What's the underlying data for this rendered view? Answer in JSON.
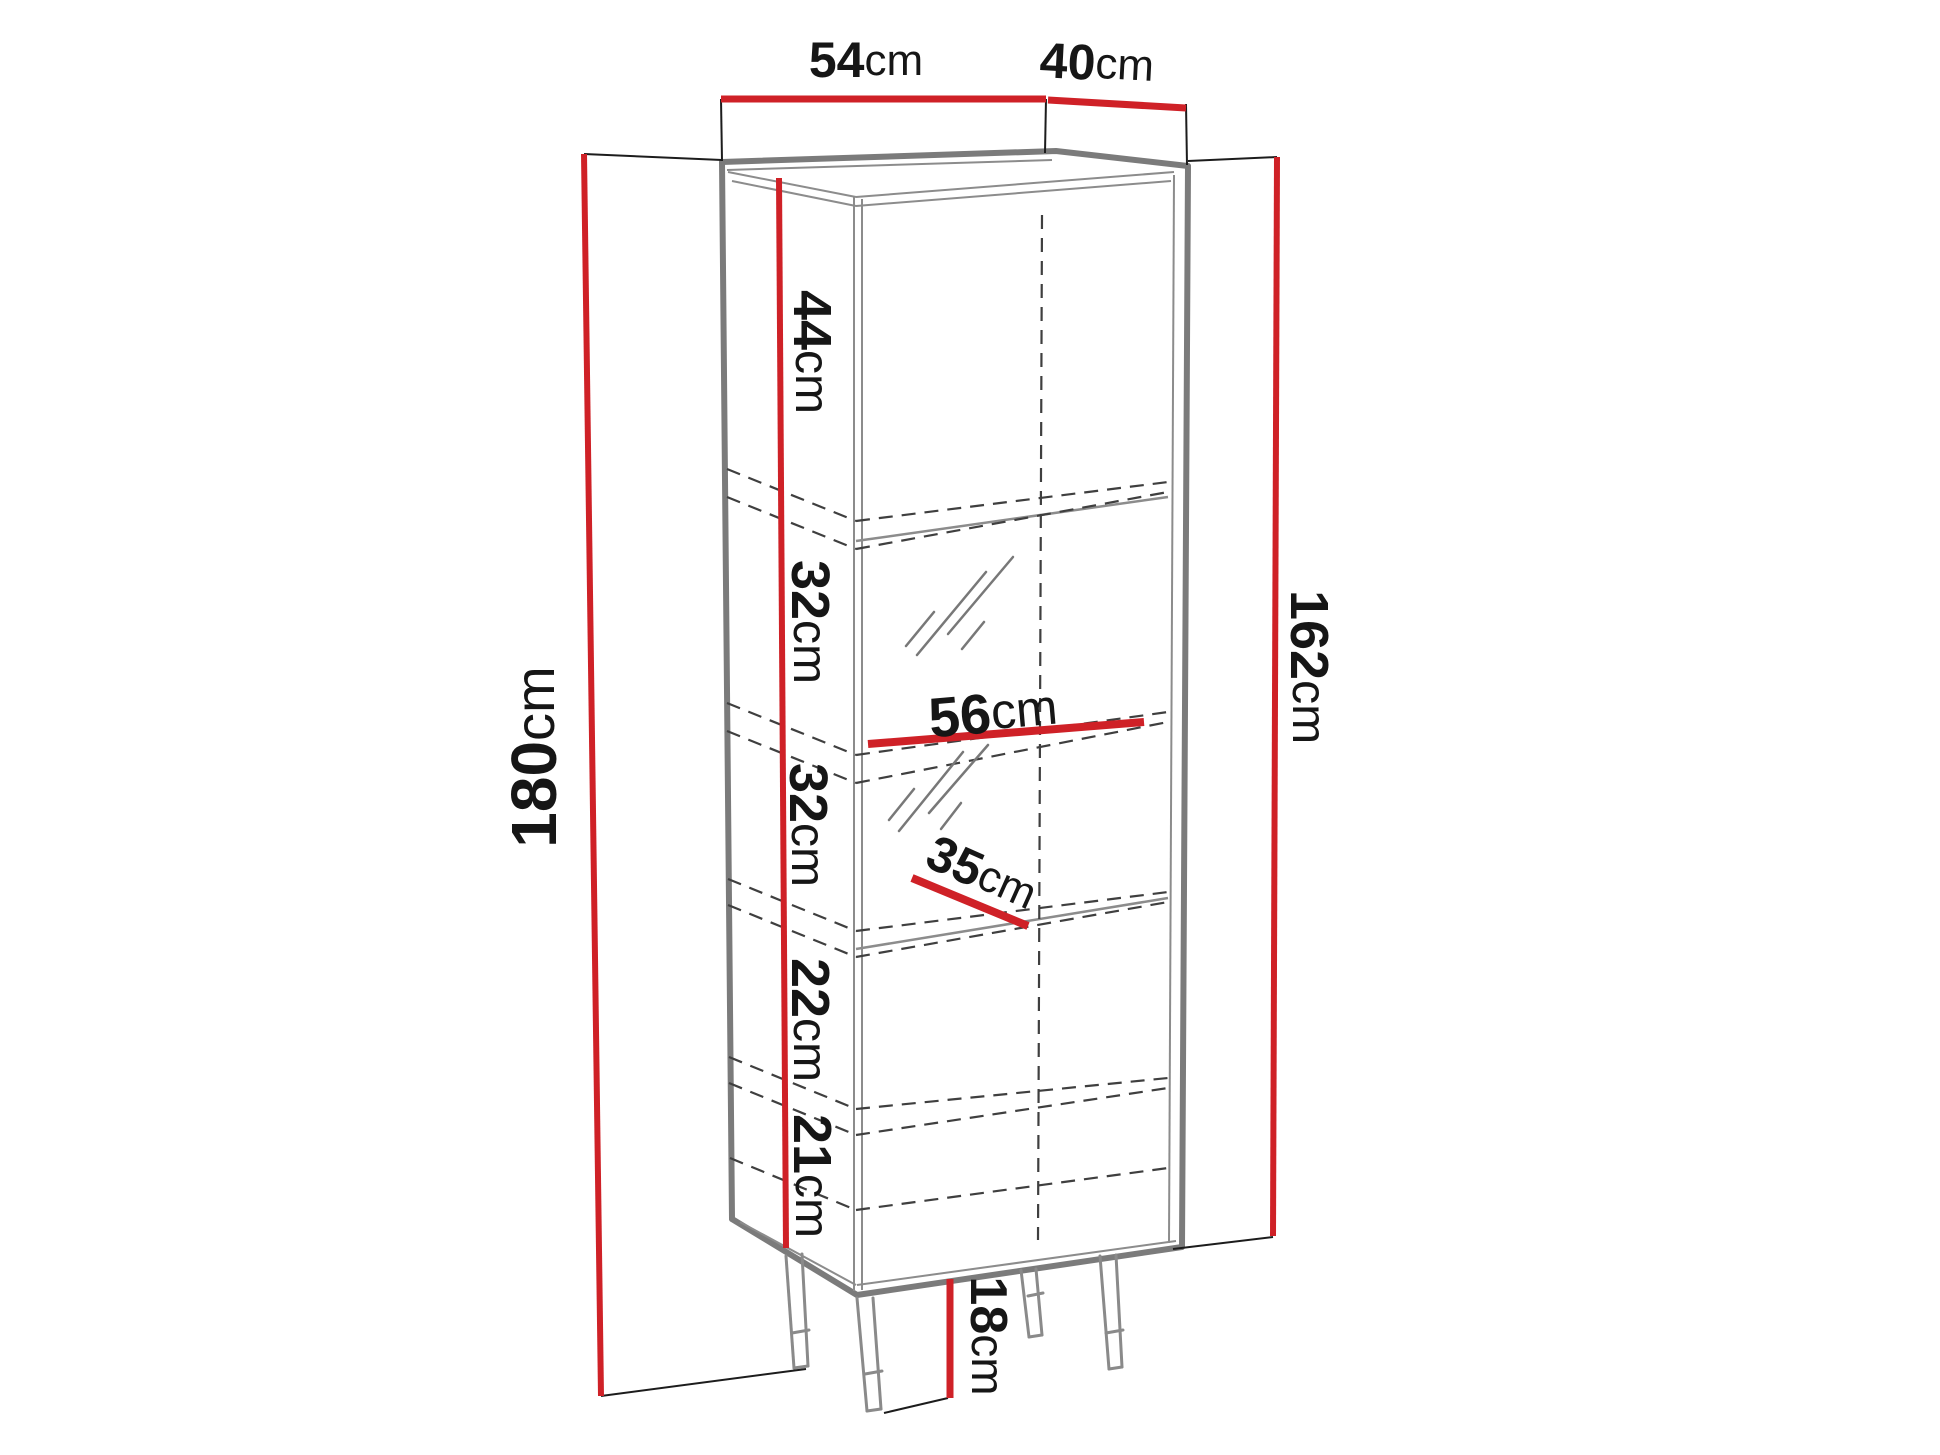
{
  "diagram": {
    "top_width": {
      "num": "54",
      "unit": "cm"
    },
    "top_depth": {
      "num": "40",
      "unit": "cm"
    },
    "total_height": {
      "num": "180",
      "unit": "cm"
    },
    "body_height": {
      "num": "162",
      "unit": "cm"
    },
    "sections": [
      {
        "num": "44",
        "unit": "cm"
      },
      {
        "num": "32",
        "unit": "cm"
      },
      {
        "num": "32",
        "unit": "cm"
      },
      {
        "num": "22",
        "unit": "cm"
      },
      {
        "num": "21",
        "unit": "cm"
      }
    ],
    "shelf_width": {
      "num": "56",
      "unit": "cm"
    },
    "shelf_depth": {
      "num": "35",
      "unit": "cm"
    },
    "leg_height": {
      "num": "18",
      "unit": "cm"
    }
  },
  "colors": {
    "dimension_red": "#cf2127",
    "outline_gray": "#7b7b7b",
    "line_gray": "#8c8c8c",
    "dash_dark": "#3f3f3f",
    "extension_black": "#1c1c1c",
    "label_black": "#161616",
    "background": "#ffffff"
  }
}
